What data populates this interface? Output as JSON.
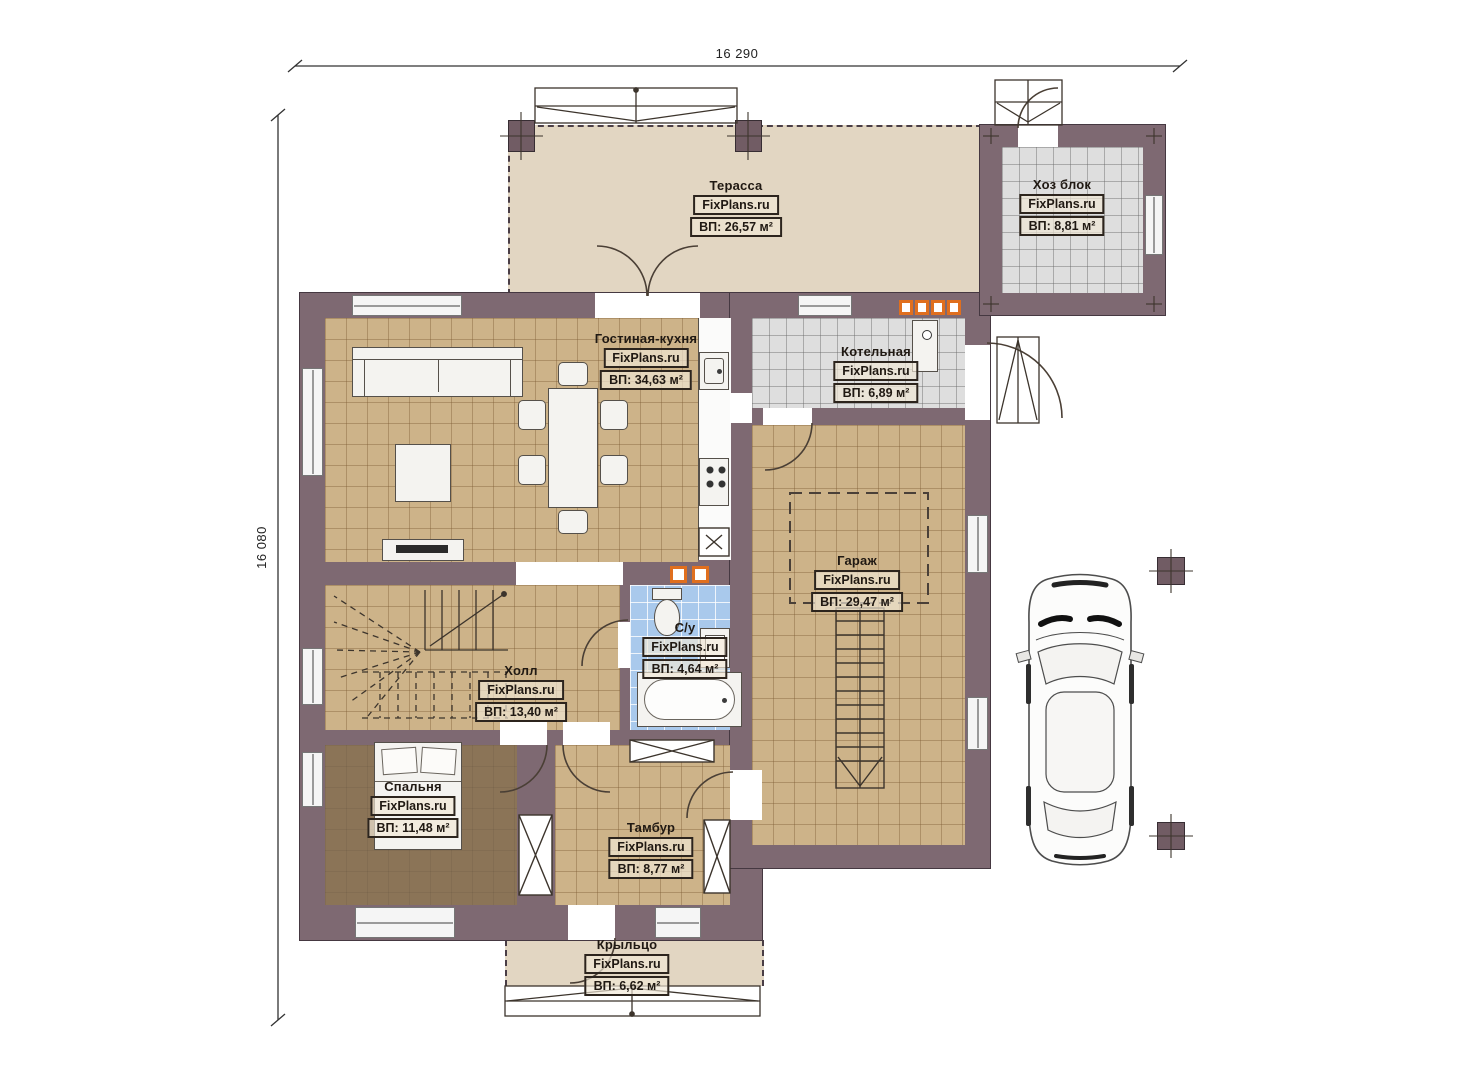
{
  "plan": {
    "title": "План первого этажа",
    "watermark": "FixPlans.ru",
    "dimensions": {
      "top": "16 290",
      "left": "16 080"
    },
    "colors": {
      "wall": "#7e6972",
      "floor_tile_tan": "#cdb389",
      "floor_tile_gray": "#dedede",
      "floor_tile_blue": "#a9c9ec",
      "floor_bedroom": "#8b7457",
      "terrace": "#e2d6c2",
      "vent_accent_orange": "#e06f1e"
    },
    "rooms": [
      {
        "id": "terrace",
        "name": "Терасса",
        "area": "ВП: 26,57 м²"
      },
      {
        "id": "hozblok",
        "name": "Хоз блок",
        "area": "ВП: 8,81 м²"
      },
      {
        "id": "living",
        "name": "Гостиная-кухня",
        "area": "ВП: 34,63 м²"
      },
      {
        "id": "boiler",
        "name": "Котельная",
        "area": "ВП: 6,89 м²"
      },
      {
        "id": "garage",
        "name": "Гараж",
        "area": "ВП: 29,47 м²"
      },
      {
        "id": "bath",
        "name": "С/у",
        "area": "ВП: 4,64 м²"
      },
      {
        "id": "hall",
        "name": "Холл",
        "area": "ВП: 13,40 м²"
      },
      {
        "id": "bedroom",
        "name": "Спальня",
        "area": "ВП: 11,48 м²"
      },
      {
        "id": "tambour",
        "name": "Тамбур",
        "area": "ВП: 8,77 м²"
      },
      {
        "id": "porch",
        "name": "Крыльцо",
        "area": "ВП: 6,62 м²"
      }
    ]
  }
}
